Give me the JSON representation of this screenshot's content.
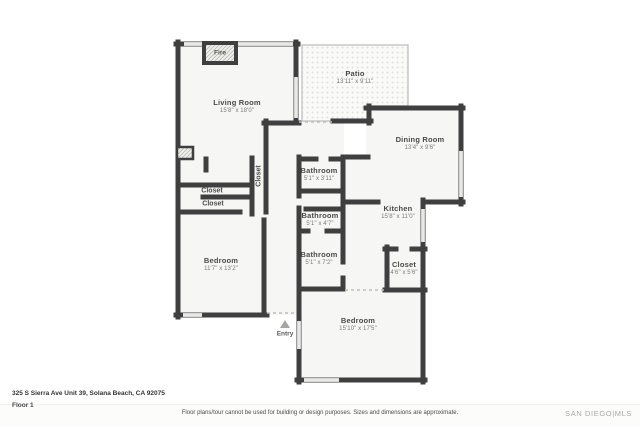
{
  "floorplan": {
    "rooms": [
      {
        "name": "Living Room",
        "dims": "15'8\" x 18'0\""
      },
      {
        "name": "Patio",
        "dims": "13'11\" x 9'11\""
      },
      {
        "name": "Dining Room",
        "dims": "13'4\" x 9'6\""
      },
      {
        "name": "Kitchen",
        "dims": "15'8\" x 11'0\""
      },
      {
        "name": "Bathroom",
        "dims": "5'1\" x 3'11\""
      },
      {
        "name": "Bathroom",
        "dims": "5'1\" x 4'7\""
      },
      {
        "name": "Bathroom",
        "dims": "5'1\" x 7'2\""
      },
      {
        "name": "Closet",
        "dims": "4'6\" x 5'6\""
      },
      {
        "name": "Bedroom",
        "dims": "11'7\" x 13'2\""
      },
      {
        "name": "Bedroom",
        "dims": "15'10\" x 17'5\""
      }
    ],
    "labels": {
      "closet_vertical": "Closet",
      "closet_1": "Closet",
      "closet_2": "Closet",
      "fire": "Fire",
      "entry": "Entry"
    },
    "colors": {
      "wall": "#3f3f3f",
      "window": "#e3e3e3",
      "floor": "#f6f6f4"
    }
  },
  "footer": {
    "address": "325 S Sierra Ave Unit 39, Solana Beach, CA 92075",
    "floor": "Floor 1",
    "disclaimer": "Floor plans/tour cannot be used for building or design purposes. Sizes and dimensions are approximate.",
    "brand": "SAN DIEGO|MLS"
  }
}
